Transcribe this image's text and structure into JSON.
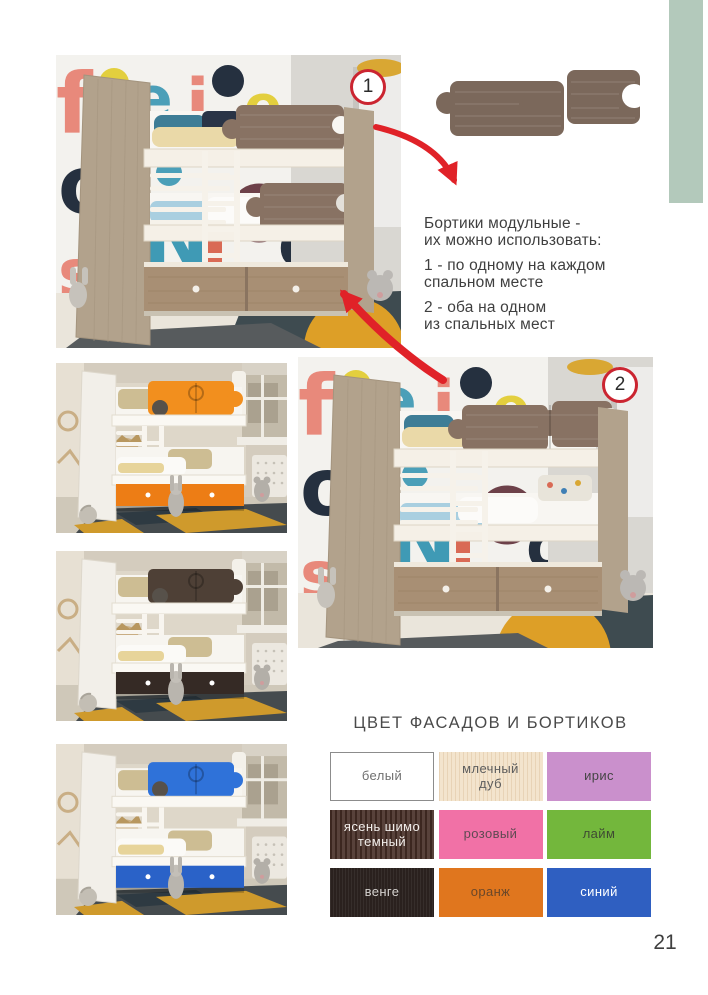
{
  "page": {
    "number": "21"
  },
  "colors": {
    "accent_bar": "#b3c9bb",
    "arrow": "#e02228",
    "badge_border": "#cb2531",
    "badge_text": "#2b2b2b",
    "body_text": "#3f3f3f",
    "title_text": "#4a4a4a",
    "wood": "#7b685b",
    "rail_main": "#887263",
    "rail_orange": "#f28f1e",
    "drawer_orange": "#ed7d15",
    "rail_wenge": "#4e4036",
    "drawer_wenge": "#352a25",
    "rail_blue": "#2f72d9",
    "drawer_blue": "#2a62c8"
  },
  "badges": {
    "first": "1",
    "second": "2"
  },
  "note": {
    "paragraphs": [
      [
        "Бортики модульные -",
        "их можно использовать:"
      ],
      [
        "1 - по одному на каждом",
        "спальном месте"
      ],
      [
        "2 - оба на одном",
        "из спальных мест"
      ]
    ]
  },
  "letters": [
    "f",
    "e",
    "i",
    "e",
    "o",
    "N",
    "s",
    "q"
  ],
  "palette": {
    "title": "ЦВЕТ ФАСАДОВ И БОРТИКОВ",
    "swatches": [
      {
        "label": "белый",
        "bg": "#ffffff",
        "text": "#6f6f6f",
        "border": "#8c8c8c"
      },
      {
        "label": "млечный\nдуб",
        "bg": "#f3e4cd",
        "text": "#5d5d5d",
        "grain": "light"
      },
      {
        "label": "ирис",
        "bg": "#ca90cc",
        "text": "#454545"
      },
      {
        "label": "ясень шимо\nтемный",
        "bg": "#4b342c",
        "text": "#f3efec",
        "grain": "strong"
      },
      {
        "label": "розовый",
        "bg": "#f171a6",
        "text": "#5f4a52"
      },
      {
        "label": "лайм",
        "bg": "#73b73c",
        "text": "#3f4a33"
      },
      {
        "label": "венге",
        "bg": "#2a211e",
        "text": "#d4d1ce",
        "grain": "dark"
      },
      {
        "label": "оранж",
        "bg": "#e0761e",
        "text": "#6a4729"
      },
      {
        "label": "синий",
        "bg": "#2f5fc1",
        "text": "#ffffff"
      }
    ]
  }
}
